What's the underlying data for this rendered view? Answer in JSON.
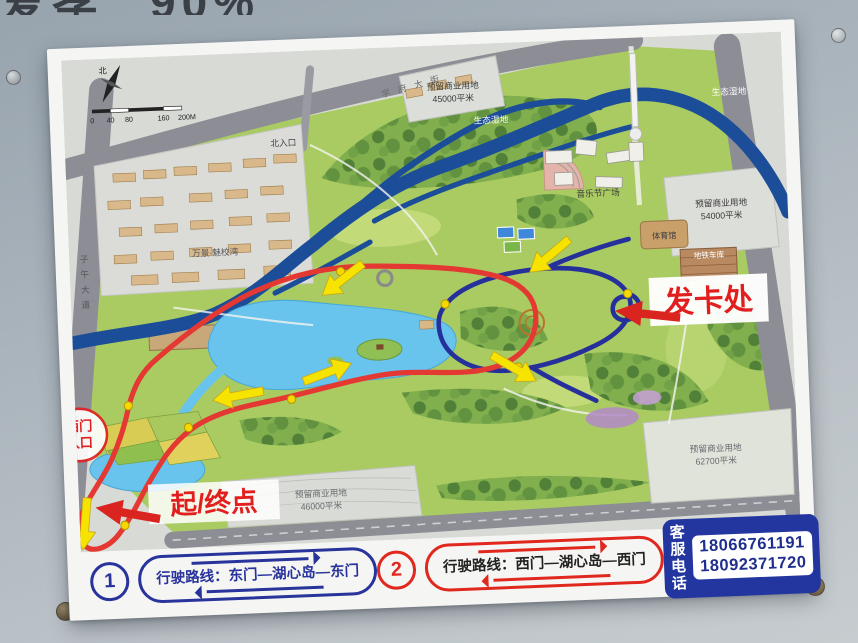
{
  "top_sign": {
    "partial_text": "爱孝",
    "partial_text2": "90%"
  },
  "map": {
    "compass_label": "北",
    "scale_ticks": [
      "0",
      "40",
      "80",
      "160",
      "200M"
    ],
    "labels": {
      "road_top": "学府大街",
      "road_left": "子午大道",
      "north_entrance": "北入口",
      "plot_n": "预留商业用地",
      "plot_n_area": "45000平米",
      "wetland_w": "生态湿地",
      "wetland_e": "生态湿地",
      "music_plaza": "音乐节广场",
      "gym": "体育馆",
      "metro_depot": "地铁车库",
      "plot_e": "预留商业用地",
      "plot_e_area": "54000平米",
      "residential": "万景·魅校湾",
      "plot_s": "预留商业用地",
      "plot_s_area": "46000平米",
      "plot_se": "预留商业用地",
      "plot_se_area": "62700平米",
      "west_gate_line1": "西门",
      "west_gate_line2": "入口",
      "card_point": "发卡处",
      "start_end": "起/终点"
    }
  },
  "legend": {
    "route1": {
      "number": "1",
      "text": "行驶路线：东门—湖心岛—东门"
    },
    "route2": {
      "number": "2",
      "text": "行驶路线：西门—湖心岛—西门"
    },
    "service": {
      "label_line1": "客服",
      "label_line2": "电话",
      "phone1": "18066761191",
      "phone2": "18092371720"
    }
  },
  "colors": {
    "route_red": "#e43833",
    "route_blue": "#26309b",
    "arrow_yellow": "#f6e400",
    "river": "#1c4d99",
    "lake": "#68c4ec",
    "legend_blue": "#28339b",
    "legend_red": "#e0281f"
  }
}
